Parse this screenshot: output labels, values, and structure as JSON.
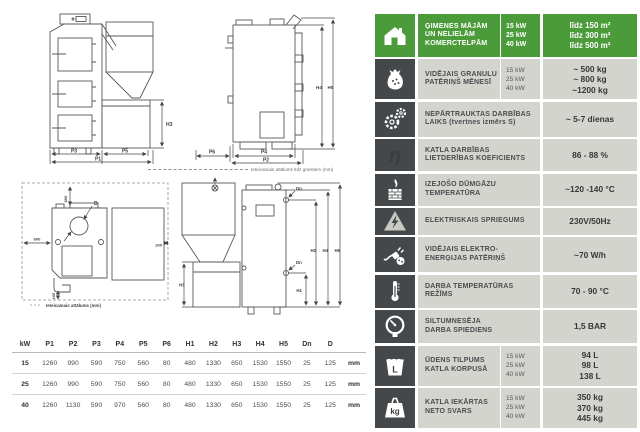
{
  "drawings": {
    "front_view": {
      "p3": "P3",
      "p5": "P5",
      "p1": "P1",
      "h3": "H3"
    },
    "side_view": {
      "h4": "H4",
      "h5": "H5",
      "p6": "P6",
      "p4": "P4",
      "p2": "P2"
    },
    "ceiling_note": "Ieteicamais attālums līdz griestiem (mm)",
    "top_view": {
      "top": "600",
      "left": "600",
      "right": "200",
      "bottom": "100",
      "d": "D",
      "legend": "Ieteicamais attālums (mm)"
    },
    "rear_view": {
      "h3": "H3",
      "h1": "H1",
      "h2": "H2",
      "h4": "H4",
      "h5": "H5",
      "dn_top": "Dn",
      "dn_bottom": "Dn"
    }
  },
  "dim_table": {
    "headers": [
      "kW",
      "P1",
      "P2",
      "P3",
      "P4",
      "P5",
      "P6",
      "H1",
      "H2",
      "H3",
      "H4",
      "H5",
      "Dn",
      "D"
    ],
    "unit": "mm",
    "rows": [
      {
        "kw": "15",
        "values": [
          "1260",
          "990",
          "590",
          "750",
          "560",
          "80",
          "480",
          "1330",
          "650",
          "1530",
          "1550",
          "25",
          "125"
        ]
      },
      {
        "kw": "25",
        "values": [
          "1260",
          "990",
          "590",
          "750",
          "560",
          "80",
          "480",
          "1330",
          "650",
          "1530",
          "1550",
          "25",
          "125"
        ]
      },
      {
        "kw": "40",
        "values": [
          "1260",
          "1130",
          "590",
          "970",
          "560",
          "80",
          "480",
          "1330",
          "650",
          "1530",
          "1550",
          "25",
          "125"
        ]
      }
    ]
  },
  "colors": {
    "accent_green": "#4c9b3a",
    "icon_dark": "#45484a",
    "cell_gray": "#d4d4cf"
  },
  "specs": [
    {
      "icon": "house-icon",
      "label_lines": [
        "ĢIMENES MĀJĀM",
        "UN NELIELĀM",
        "KOMERCTELPĀM"
      ],
      "kw": [
        "15 kW",
        "25 kW",
        "40 kW"
      ],
      "values": [
        "līdz 150 m²",
        "līdz 300 m²",
        "līdz 500 m²"
      ]
    },
    {
      "icon": "pellet-bag-icon",
      "label_lines": [
        "VIDĒJAIS GRANULU",
        "PATĒRIŅŠ MĒNESĪ"
      ],
      "kw": [
        "15 kW",
        "25 kW",
        "40 kW"
      ],
      "values": [
        "~ 500 kg",
        "~ 800 kg",
        "~1200 kg"
      ]
    },
    {
      "icon": "gears-icon",
      "label_lines": [
        "NEPĀRTRAUKTAS DARBĪBAS",
        "LAIKS (tvertnes izmērs S)"
      ],
      "values": [
        "~ 5-7 dienas"
      ]
    },
    {
      "icon": "eta-efficiency-icon",
      "label_lines": [
        "KATLA DARBĪBAS",
        "LIETDERĪBAS KOEFICIENTS"
      ],
      "values": [
        "86 - 88 %"
      ]
    },
    {
      "icon": "chimney-icon",
      "label_lines": [
        "IZEJOŠO DŪMGĀZU",
        "TEMPERATŪRA"
      ],
      "values": [
        "~120 -140 °C"
      ]
    },
    {
      "icon": "voltage-triangle-icon",
      "label_lines": [
        "ELEKTRISKAIS SPRIEGUMS"
      ],
      "values": [
        "230V/50Hz"
      ]
    },
    {
      "icon": "power-plug-icon",
      "label_lines": [
        "VIDĒJAIS ELEKTRO-",
        "ENERĢIJAS PATĒRIŅŠ"
      ],
      "values": [
        "~70 W/h"
      ]
    },
    {
      "icon": "thermometer-icon",
      "label_lines": [
        "DARBA TEMPERATŪRAS",
        "REŽĪMS"
      ],
      "values": [
        "70 - 90 °C"
      ]
    },
    {
      "icon": "pressure-gauge-icon",
      "label_lines": [
        "SILTUMNESĒJA",
        "DARBA SPIEDIENS"
      ],
      "values": [
        "1,5 BAR"
      ]
    },
    {
      "icon": "water-bucket-icon",
      "label_lines": [
        "ŪDENS TILPUMS",
        "KATLA KORPUSĀ"
      ],
      "kw": [
        "15 kW",
        "25 kW",
        "40 kW"
      ],
      "values": [
        "94 L",
        "98 L",
        "138 L"
      ]
    },
    {
      "icon": "weight-kg-icon",
      "label_lines": [
        "KATLA IEKĀRTAS",
        "NETO SVARS"
      ],
      "kw": [
        "15 kW",
        "25 kW",
        "40 kW"
      ],
      "values": [
        "350 kg",
        "370 kg",
        "445 kg"
      ]
    }
  ]
}
